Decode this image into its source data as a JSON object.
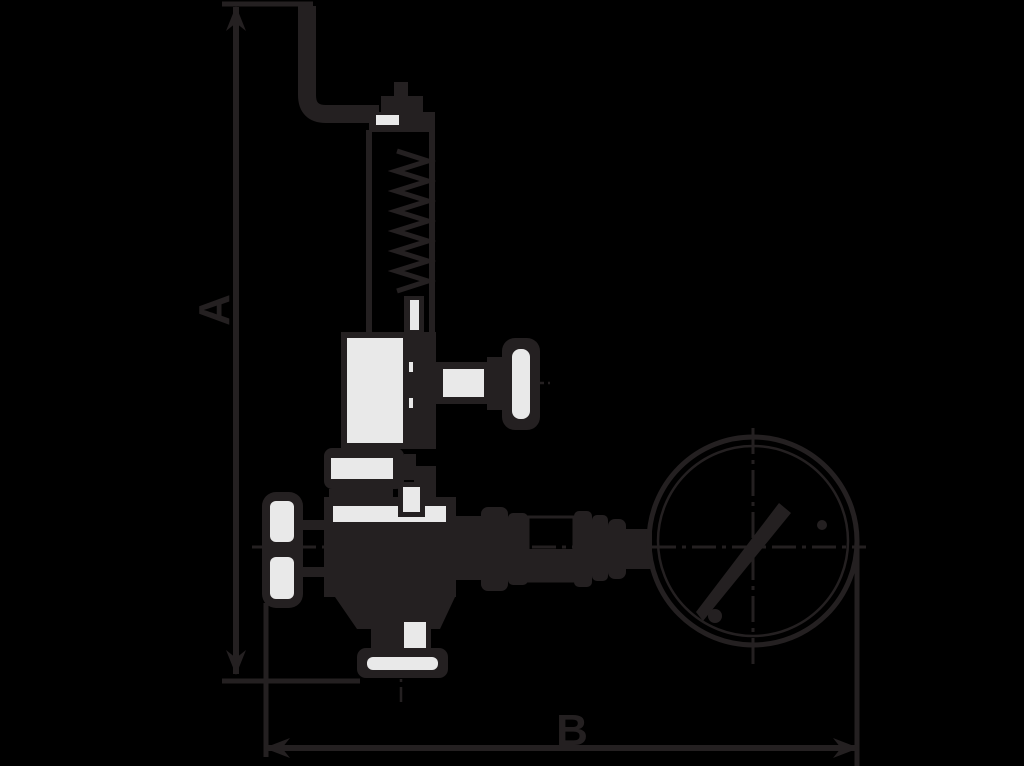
{
  "diagram": {
    "type": "technical-dimension-drawing",
    "subject": "safety-relief-valve-with-pressure-gauge",
    "dimensions": {
      "vertical_label": "A",
      "horizontal_label": "B"
    },
    "colors": {
      "background": "#000000",
      "ink": "#242021",
      "light_fill": "#e9e9e9"
    },
    "parts": [
      "bent-discharge-lever",
      "spring-bonnet-cap",
      "spring-yoke",
      "spring-coil",
      "bonnet-housing",
      "test-knob",
      "body-flange",
      "valve-body",
      "handwheel",
      "outlet-flange",
      "union-pipe-assembly",
      "pressure-gauge"
    ]
  }
}
